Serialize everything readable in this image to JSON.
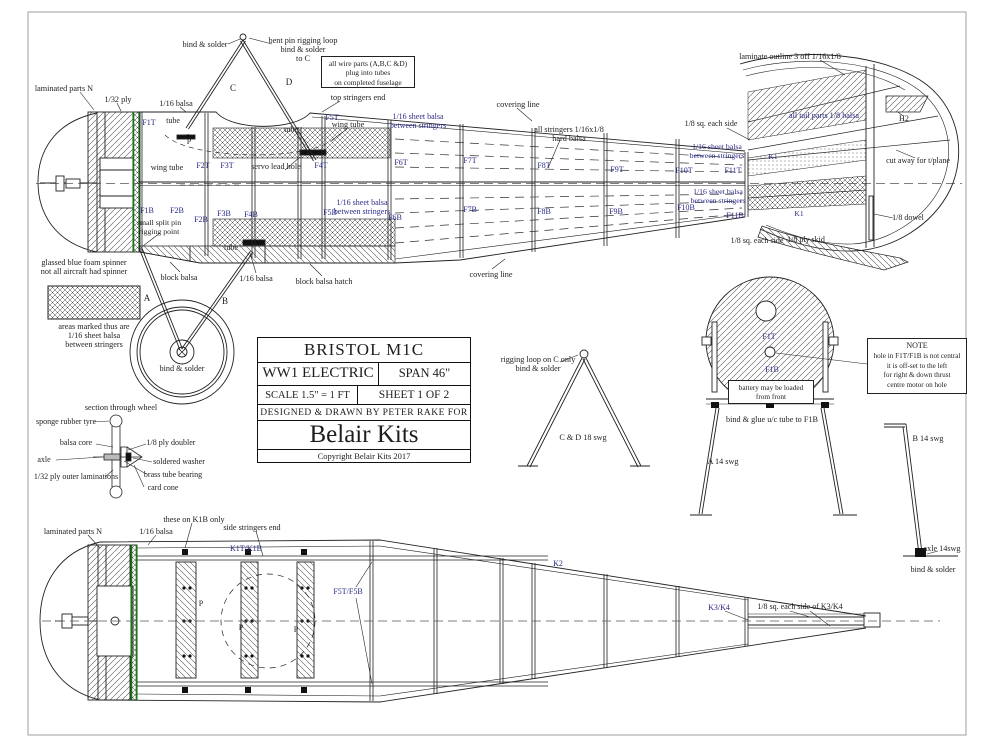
{
  "colors": {
    "ink": "#1d1d1d",
    "blue": "#2a2a85",
    "green": "#0f7a0f",
    "paper": "#ffffff"
  },
  "title_block": {
    "title": "BRISTOL M1C",
    "type": "WW1 ELECTRIC",
    "span": "SPAN 46\"",
    "scale": "SCALE 1.5\" = 1 FT",
    "sheet": "SHEET 1 OF 2",
    "designed": "DESIGNED & DRAWN BY PETER RAKE FOR",
    "brand": "Belair Kits",
    "copyright": "Copyright Belair Kits 2017"
  },
  "boxes": {
    "wire_parts": {
      "lines": [
        "all wire parts (A,B,C &D)",
        "plug into tubes",
        "on completed fuselage"
      ]
    },
    "note": {
      "title": "NOTE",
      "lines": [
        "hole in F1T/F1B is not central",
        "it is off-set to the left",
        "for right & down thrust",
        "centre motor on hole"
      ]
    },
    "battery": {
      "lines": [
        "battery may be loaded",
        "from front"
      ]
    }
  },
  "labels": [
    {
      "t": "laminated parts N",
      "x": 64,
      "y": 84,
      "c": "k",
      "s": 8.2
    },
    {
      "t": "1/32 ply",
      "x": 118,
      "y": 95,
      "c": "k",
      "s": 8.2
    },
    {
      "t": "1/16 balsa",
      "x": 176,
      "y": 99,
      "c": "k",
      "s": 8.2
    },
    {
      "t": "bind & solder",
      "x": 205,
      "y": 40,
      "c": "k",
      "s": 8.2
    },
    {
      "t": "bent pin rigging loop\nbind & solder\nto C",
      "x": 303,
      "y": 36,
      "c": "k",
      "s": 8.2
    },
    {
      "t": "C",
      "x": 233,
      "y": 83,
      "c": "k",
      "s": 9
    },
    {
      "t": "D",
      "x": 289,
      "y": 77,
      "c": "k",
      "s": 9
    },
    {
      "t": "top stringers end",
      "x": 358,
      "y": 93,
      "c": "k",
      "s": 8.2
    },
    {
      "t": "covering line",
      "x": 518,
      "y": 100,
      "c": "k",
      "s": 8.2
    },
    {
      "t": "covering line",
      "x": 491,
      "y": 270,
      "c": "k",
      "s": 8.2
    },
    {
      "t": "all stringers 1/16x1/8\nhard balsa",
      "x": 569,
      "y": 125,
      "c": "k",
      "s": 8.2
    },
    {
      "t": "1/16 sheet balsa\nbetween stringers",
      "x": 418,
      "y": 113,
      "c": "b",
      "s": 8
    },
    {
      "t": "wing tube",
      "x": 167,
      "y": 163,
      "c": "k",
      "s": 8.2
    },
    {
      "t": "wing tube",
      "x": 348,
      "y": 120,
      "c": "k",
      "s": 8.2
    },
    {
      "t": "servo lead hole",
      "x": 276,
      "y": 162,
      "c": "k",
      "s": 8.2
    },
    {
      "t": "tube",
      "x": 173,
      "y": 117,
      "c": "k",
      "s": 8
    },
    {
      "t": "tube",
      "x": 291,
      "y": 126,
      "c": "k",
      "s": 8
    },
    {
      "t": "tube",
      "x": 231,
      "y": 244,
      "c": "k",
      "s": 8
    },
    {
      "t": "small split pin\nrigging point",
      "x": 159,
      "y": 219,
      "c": "k",
      "s": 7.8
    },
    {
      "t": "glassed blue foam spinner\nnot all aircraft had spinner",
      "x": 84,
      "y": 258,
      "c": "k",
      "s": 8.2
    },
    {
      "t": "block balsa",
      "x": 179,
      "y": 273,
      "c": "k",
      "s": 8.2
    },
    {
      "t": "1/16 balsa",
      "x": 256,
      "y": 274,
      "c": "k",
      "s": 8.2
    },
    {
      "t": "block balsa hatch",
      "x": 324,
      "y": 277,
      "c": "k",
      "s": 8.2
    },
    {
      "t": "A",
      "x": 147,
      "y": 293,
      "c": "k",
      "s": 9
    },
    {
      "t": "B",
      "x": 225,
      "y": 296,
      "c": "k",
      "s": 9
    },
    {
      "t": "bind & solder",
      "x": 182,
      "y": 364,
      "c": "k",
      "s": 8.2
    },
    {
      "t": "1/16 sheet balsa\nbetween stringers",
      "x": 362,
      "y": 199,
      "c": "b",
      "s": 8
    },
    {
      "t": "areas marked thus are\n1/16 sheet balsa\nbetween stringers",
      "x": 94,
      "y": 322,
      "c": "k",
      "s": 8.2
    },
    {
      "t": "laminate outline 3 off 1/16x1/8",
      "x": 790,
      "y": 52,
      "c": "k",
      "s": 8.2
    },
    {
      "t": "all tail parts 1/8 balsa",
      "x": 824,
      "y": 111,
      "c": "b",
      "s": 8.2
    },
    {
      "t": "H2",
      "x": 904,
      "y": 114,
      "c": "k",
      "s": 8.2
    },
    {
      "t": "1/8 sq. each side",
      "x": 711,
      "y": 120,
      "c": "k",
      "s": 8
    },
    {
      "t": "1/16 sheet balsa\nbetween stringers",
      "x": 717,
      "y": 143,
      "c": "b",
      "s": 7.8
    },
    {
      "t": "1/16 sheet balsa\nbetween stringers",
      "x": 718,
      "y": 188,
      "c": "b",
      "s": 7.8
    },
    {
      "t": "1/8 sq. each side",
      "x": 757,
      "y": 237,
      "c": "k",
      "s": 8
    },
    {
      "t": "1/8 ply skid",
      "x": 806,
      "y": 236,
      "c": "k",
      "s": 8
    },
    {
      "t": "1/8 dowel",
      "x": 908,
      "y": 214,
      "c": "k",
      "s": 8
    },
    {
      "t": "cut away for t/plane",
      "x": 918,
      "y": 157,
      "c": "k",
      "s": 8
    },
    {
      "t": "K1",
      "x": 773,
      "y": 153,
      "c": "b",
      "s": 7.5
    },
    {
      "t": "K1",
      "x": 799,
      "y": 210,
      "c": "b",
      "s": 7.5
    },
    {
      "t": "P",
      "x": 189,
      "y": 138,
      "c": "k",
      "s": 8
    },
    {
      "t": "F1T",
      "x": 149,
      "y": 119,
      "c": "b",
      "s": 8
    },
    {
      "t": "F2T",
      "x": 203,
      "y": 162,
      "c": "b",
      "s": 8
    },
    {
      "t": "F3T",
      "x": 227,
      "y": 162,
      "c": "b",
      "s": 8
    },
    {
      "t": "F4T",
      "x": 321,
      "y": 162,
      "c": "b",
      "s": 8
    },
    {
      "t": "F5T",
      "x": 332,
      "y": 114,
      "c": "b",
      "s": 8
    },
    {
      "t": "F6T",
      "x": 401,
      "y": 159,
      "c": "b",
      "s": 8
    },
    {
      "t": "F7T",
      "x": 470,
      "y": 157,
      "c": "b",
      "s": 8
    },
    {
      "t": "F8T",
      "x": 544,
      "y": 162,
      "c": "b",
      "s": 8
    },
    {
      "t": "F9T",
      "x": 617,
      "y": 166,
      "c": "b",
      "s": 8
    },
    {
      "t": "F10T",
      "x": 684,
      "y": 167,
      "c": "b",
      "s": 8
    },
    {
      "t": "F11T",
      "x": 733,
      "y": 167,
      "c": "b",
      "s": 8
    },
    {
      "t": "F1B",
      "x": 147,
      "y": 207,
      "c": "b",
      "s": 8
    },
    {
      "t": "F2B",
      "x": 177,
      "y": 207,
      "c": "b",
      "s": 8
    },
    {
      "t": "F2B",
      "x": 201,
      "y": 216,
      "c": "b",
      "s": 8
    },
    {
      "t": "F3B",
      "x": 224,
      "y": 210,
      "c": "b",
      "s": 8
    },
    {
      "t": "F4B",
      "x": 251,
      "y": 211,
      "c": "b",
      "s": 8
    },
    {
      "t": "F5B",
      "x": 330,
      "y": 209,
      "c": "b",
      "s": 8
    },
    {
      "t": "F6B",
      "x": 395,
      "y": 214,
      "c": "b",
      "s": 8
    },
    {
      "t": "F7B",
      "x": 470,
      "y": 206,
      "c": "b",
      "s": 8
    },
    {
      "t": "F8B",
      "x": 544,
      "y": 208,
      "c": "b",
      "s": 8
    },
    {
      "t": "F9B",
      "x": 616,
      "y": 208,
      "c": "b",
      "s": 8
    },
    {
      "t": "F10B",
      "x": 686,
      "y": 204,
      "c": "b",
      "s": 8
    },
    {
      "t": "F11B",
      "x": 735,
      "y": 212,
      "c": "b",
      "s": 8
    },
    {
      "t": "rigging loop on C only\nbind & solder",
      "x": 538,
      "y": 355,
      "c": "k",
      "s": 8.2
    },
    {
      "t": "C & D 18 swg",
      "x": 583,
      "y": 433,
      "c": "k",
      "s": 8.2
    },
    {
      "t": "A 14 swg",
      "x": 723,
      "y": 457,
      "c": "k",
      "s": 8.2
    },
    {
      "t": "bind & glue u/c tube to F1B",
      "x": 772,
      "y": 415,
      "c": "k",
      "s": 8.2
    },
    {
      "t": "F1T",
      "x": 769,
      "y": 333,
      "c": "b",
      "s": 8
    },
    {
      "t": "F1B",
      "x": 772,
      "y": 366,
      "c": "b",
      "s": 8
    },
    {
      "t": "B 14 swg",
      "x": 928,
      "y": 434,
      "c": "k",
      "s": 8.2
    },
    {
      "t": "axle 14swg",
      "x": 942,
      "y": 544,
      "c": "k",
      "s": 8.2
    },
    {
      "t": "bind & solder",
      "x": 933,
      "y": 565,
      "c": "k",
      "s": 8.2
    },
    {
      "t": "section through wheel",
      "x": 121,
      "y": 403,
      "c": "k",
      "s": 8.2
    },
    {
      "t": "sponge rubber tyre",
      "x": 66,
      "y": 418,
      "c": "k",
      "s": 8
    },
    {
      "t": "balsa core",
      "x": 76,
      "y": 439,
      "c": "k",
      "s": 8
    },
    {
      "t": "axle",
      "x": 44,
      "y": 456,
      "c": "k",
      "s": 8
    },
    {
      "t": "1/32 ply outer laminations",
      "x": 76,
      "y": 473,
      "c": "k",
      "s": 8
    },
    {
      "t": "1/8 ply doubler",
      "x": 171,
      "y": 439,
      "c": "k",
      "s": 8
    },
    {
      "t": "soldered washer",
      "x": 179,
      "y": 458,
      "c": "k",
      "s": 8
    },
    {
      "t": "brass tube bearing",
      "x": 173,
      "y": 471,
      "c": "k",
      "s": 8
    },
    {
      "t": "card cone",
      "x": 163,
      "y": 484,
      "c": "k",
      "s": 8
    },
    {
      "t": "laminated parts N",
      "x": 73,
      "y": 527,
      "c": "k",
      "s": 8.2
    },
    {
      "t": "1/16 balsa",
      "x": 156,
      "y": 527,
      "c": "k",
      "s": 8.2
    },
    {
      "t": "these on K1B only",
      "x": 194,
      "y": 515,
      "c": "k",
      "s": 8.2
    },
    {
      "t": "side stringers end",
      "x": 252,
      "y": 523,
      "c": "k",
      "s": 8.2
    },
    {
      "t": "K1T/K1B",
      "x": 246,
      "y": 545,
      "c": "b",
      "s": 8
    },
    {
      "t": "F5T/F5B",
      "x": 348,
      "y": 588,
      "c": "b",
      "s": 8
    },
    {
      "t": "P",
      "x": 201,
      "y": 600,
      "c": "k",
      "s": 8
    },
    {
      "t": "P",
      "x": 241,
      "y": 624,
      "c": "k",
      "s": 8
    },
    {
      "t": "P",
      "x": 296,
      "y": 626,
      "c": "k",
      "s": 8
    },
    {
      "t": "K2",
      "x": 558,
      "y": 560,
      "c": "b",
      "s": 8
    },
    {
      "t": "K3/K4",
      "x": 719,
      "y": 604,
      "c": "b",
      "s": 8
    },
    {
      "t": "1/8 sq. each side of K3/K4",
      "x": 800,
      "y": 603,
      "c": "k",
      "s": 8
    }
  ]
}
